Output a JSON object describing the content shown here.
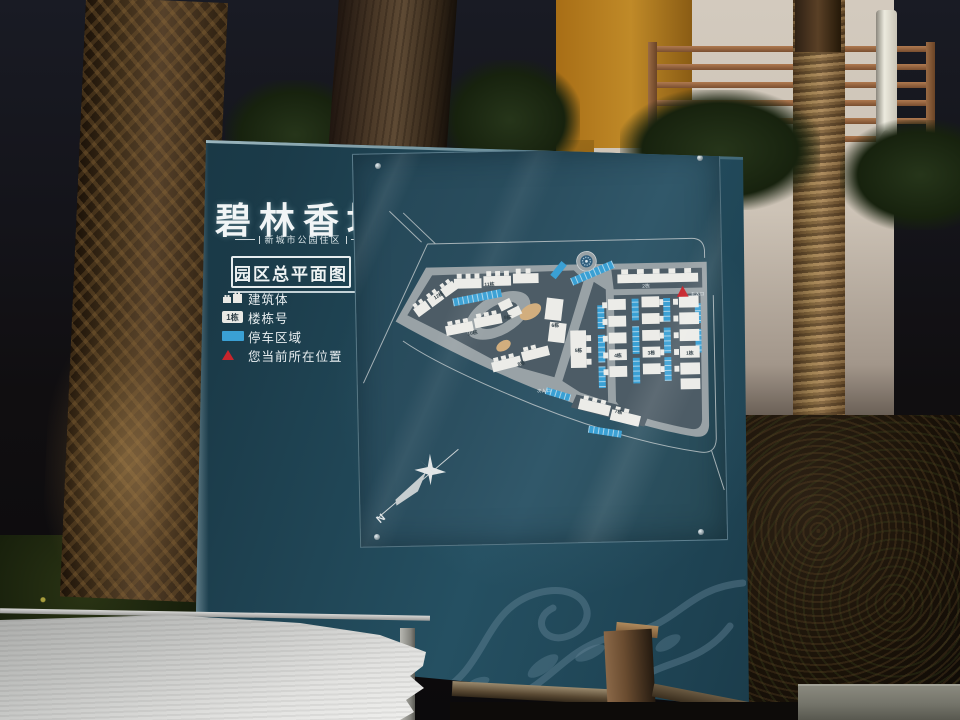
{
  "sign": {
    "title": "碧林香堤",
    "subtitle": "新城市公园住区",
    "plan_label": "园区总平面图",
    "legend": {
      "items": [
        {
          "name": "building",
          "label": "建筑体"
        },
        {
          "name": "building-number",
          "label": "楼栋号",
          "icon_text": "1栋"
        },
        {
          "name": "parking",
          "label": "停车区域"
        },
        {
          "name": "current-location",
          "label": "您当前所在位置"
        }
      ]
    },
    "map": {
      "buildings": [
        {
          "label": "1栋"
        },
        {
          "label": "2栋"
        },
        {
          "label": "3栋"
        },
        {
          "label": "4栋"
        },
        {
          "label": "5栋"
        },
        {
          "label": "6栋"
        },
        {
          "label": "7栋"
        },
        {
          "label": "8栋"
        },
        {
          "label": "9栋"
        },
        {
          "label": "10栋"
        },
        {
          "label": "11栋"
        },
        {
          "label": "12栋"
        }
      ],
      "entrances": [
        {
          "label": "主入口"
        },
        {
          "label": "次入口"
        }
      ],
      "compass_label": "N"
    }
  },
  "colors": {
    "sign_teal": "#1b3b49",
    "acrylic_teal": "#2b4f60",
    "road_gray": "#99a2a6",
    "block_gray": "#4d5c66",
    "building_white": "#ecece8",
    "parking_blue": "#3aa0d4",
    "marker_red": "#c8252c",
    "landscape_tan": "#d2ae7e",
    "wall_cream": "#cdc3b6",
    "wall_orange": "#c08a28"
  }
}
